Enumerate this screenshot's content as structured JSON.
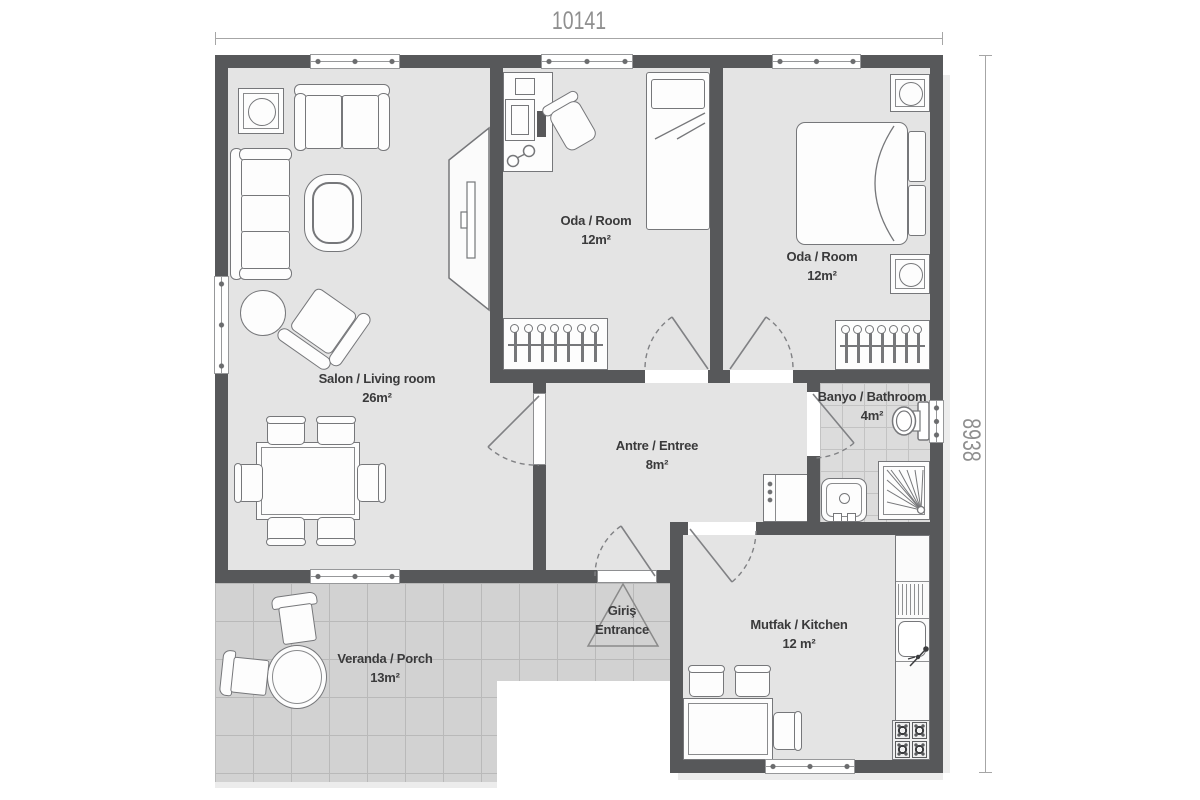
{
  "dimensions": {
    "width": "10141",
    "height": "8938"
  },
  "rooms": [
    {
      "name": "Salon / Living room",
      "area": "26m²"
    },
    {
      "name": "Oda / Room",
      "area": "12m²"
    },
    {
      "name": "Oda / Room",
      "area": "12m²"
    },
    {
      "name": "Antre / Entree",
      "area": "8m²"
    },
    {
      "name": "Banyo / Bathroom",
      "area": "4m²"
    },
    {
      "name": "Mutfak / Kitchen",
      "area": "12 m²"
    },
    {
      "name": "Veranda / Porch",
      "area": "13m²"
    }
  ],
  "entrance": {
    "line1": "Giriş",
    "line2": "Entrance"
  },
  "colors": {
    "wall": "#57585a",
    "floor": "#e4e4e4",
    "tile": "#d2d2d2",
    "outline": "#76777a",
    "label": "#3a3a3b",
    "dimension": "#8f8f8f"
  }
}
